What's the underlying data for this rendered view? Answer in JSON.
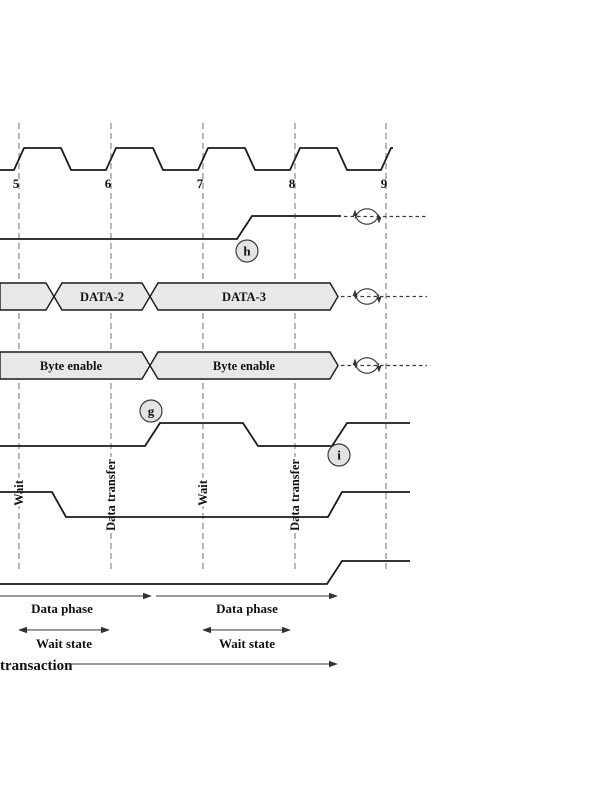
{
  "figure": {
    "kind": "bus-transaction-timing-diagram",
    "colors": {
      "trace": "#1a1a1a",
      "gridline": "#8a8a8a",
      "bus_fill": "#e8e8e8",
      "point_circle_fill": "#e3e3e3",
      "annotation": "#333333"
    }
  },
  "clock": {
    "tick_labels": [
      "5",
      "6",
      "7",
      "8",
      "9"
    ]
  },
  "point_labels": {
    "h": "h",
    "g": "g",
    "i": "i"
  },
  "data_bus": {
    "segments": [
      "DATA-2",
      "DATA-3"
    ]
  },
  "byte_enable_bus": {
    "segments": [
      "Byte enable",
      "Byte enable"
    ]
  },
  "phase_labels": [
    "Wait",
    "Data transfer",
    "Wait",
    "Data transfer"
  ],
  "annotations": {
    "data_phases": [
      "Data phase",
      "Data phase"
    ],
    "wait_states": [
      "Wait state",
      "Wait state"
    ],
    "transaction": "transaction"
  }
}
